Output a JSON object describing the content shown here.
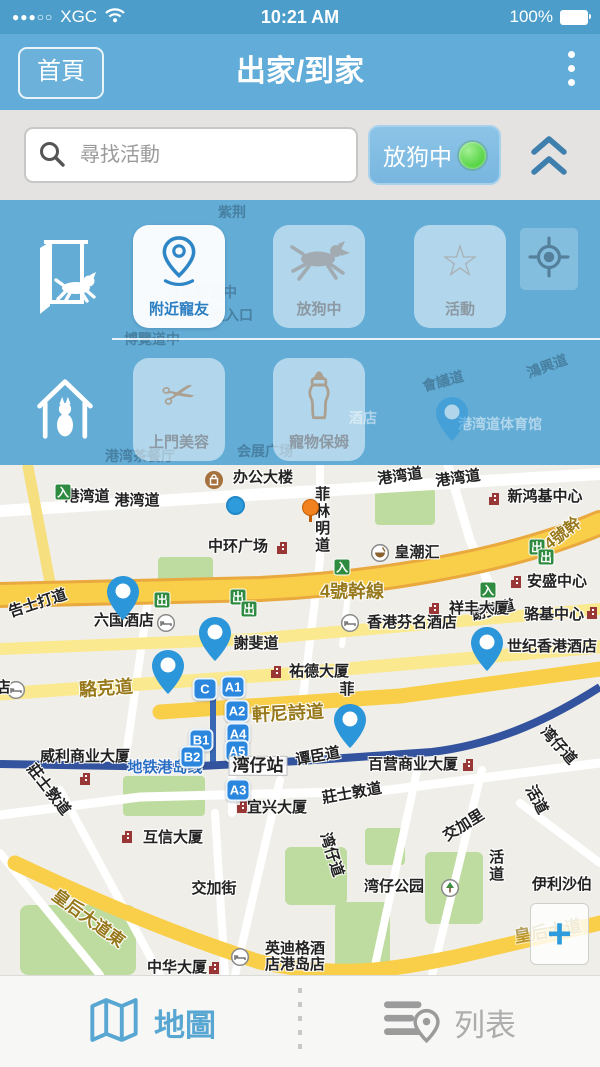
{
  "status_bar": {
    "signal_dots": "●●●○○",
    "carrier": "XGC",
    "time": "10:21 AM",
    "battery": "100%"
  },
  "header": {
    "back_label": "首頁",
    "title": "出家/到家"
  },
  "search": {
    "placeholder": "尋找活動",
    "toggle_label": "放狗中",
    "toggle_on_color": "#4ED13C"
  },
  "panel": {
    "row1": {
      "buttons": [
        {
          "label": "附近寵友",
          "icon": "location-pin-icon",
          "active": true
        },
        {
          "label": "放狗中",
          "icon": "running-dog-icon",
          "active": false
        },
        {
          "label": "活動",
          "icon": "star-icon",
          "active": false
        }
      ]
    },
    "row2": {
      "buttons": [
        {
          "label": "上門美容",
          "icon": "scissors-icon",
          "active": false
        },
        {
          "label": "寵物保姆",
          "icon": "baby-bottle-icon",
          "active": false
        }
      ]
    },
    "bg_labels": [
      {
        "t": "紫荆",
        "x": 232,
        "y": 12
      },
      {
        "t": "会议展览中",
        "x": 202,
        "y": 92
      },
      {
        "t": "道入口",
        "x": 232,
        "y": 115
      },
      {
        "t": "博覽道中",
        "x": 152,
        "y": 139
      },
      {
        "t": "會議道",
        "x": 443,
        "y": 181,
        "rot": -15
      },
      {
        "t": "鴻興道",
        "x": 547,
        "y": 166,
        "rot": -20
      },
      {
        "t": "港湾道体育馆",
        "x": 500,
        "y": 224,
        "light": 1
      },
      {
        "t": "酒店",
        "x": 363,
        "y": 218,
        "light": 1
      },
      {
        "t": "港湾茶餐厅",
        "x": 140,
        "y": 256
      },
      {
        "t": "会展广场",
        "x": 265,
        "y": 251
      }
    ]
  },
  "map": {
    "street_labels": [
      {
        "t": "港湾道",
        "x": 87,
        "y": 32
      },
      {
        "t": "港湾道",
        "x": 137,
        "y": 36
      },
      {
        "t": "港湾道",
        "x": 400,
        "y": 12,
        "rot": -8
      },
      {
        "t": "港湾道",
        "x": 458,
        "y": 14,
        "rot": -8
      },
      {
        "t": "菲林明道",
        "x": 321,
        "y": 55,
        "vert": 1
      },
      {
        "t": "告士打道",
        "x": 38,
        "y": 139,
        "rot": -18
      },
      {
        "t": "4號幹線",
        "x": 352,
        "y": 127,
        "gold": 1,
        "size": 18
      },
      {
        "t": "4號幹",
        "x": 563,
        "y": 69,
        "gold": 1,
        "rot": -38,
        "size": 16
      },
      {
        "t": "謝斐道",
        "x": 256,
        "y": 179
      },
      {
        "t": "谢斐道",
        "x": 493,
        "y": 146,
        "rot": -14
      },
      {
        "t": "駱克道",
        "x": 106,
        "y": 224,
        "gold": 1,
        "size": 18,
        "rot": -4
      },
      {
        "t": "軒尼詩道",
        "x": 288,
        "y": 249,
        "gold": 1,
        "size": 18,
        "rot": -3
      },
      {
        "t": "菲",
        "x": 347,
        "y": 225
      },
      {
        "t": "谭臣道",
        "x": 318,
        "y": 292,
        "rot": -10
      },
      {
        "t": "莊士敦道",
        "x": 48,
        "y": 325,
        "rot": 52
      },
      {
        "t": "莊士敦道",
        "x": 352,
        "y": 329,
        "rot": -10
      },
      {
        "t": "湾仔道",
        "x": 558,
        "y": 281,
        "rot": 48
      },
      {
        "t": "交加里",
        "x": 464,
        "y": 361,
        "rot": -32
      },
      {
        "t": "活道",
        "x": 536,
        "y": 335,
        "rot": 62
      },
      {
        "t": "活道",
        "x": 495,
        "y": 401,
        "vert": 1
      },
      {
        "t": "湾仔道",
        "x": 331,
        "y": 390,
        "rot": 72
      },
      {
        "t": "交加街",
        "x": 214,
        "y": 424
      },
      {
        "t": "皇后大道東",
        "x": 88,
        "y": 454,
        "rot": 36,
        "gold": 1,
        "size": 17
      },
      {
        "t": "伊利沙伯",
        "x": 562,
        "y": 420
      },
      {
        "t": "皇后大道",
        "x": 548,
        "y": 467,
        "rot": -10,
        "gold": 1,
        "faint": 1
      },
      {
        "t": "世纪香港酒店",
        "x": 552,
        "y": 182
      }
    ],
    "pois": [
      {
        "icon": "bag",
        "ix": 214,
        "iy": 15,
        "t": "办公大楼",
        "tx": 263,
        "ty": 13
      },
      {
        "icon": "bldg",
        "ix": 494,
        "iy": 34,
        "t": "新鸿基中心",
        "tx": 545,
        "ty": 32
      },
      {
        "icon": "bldg",
        "ix": 282,
        "iy": 83,
        "t": "中环广场",
        "tx": 238,
        "ty": 82
      },
      {
        "icon": "bowl",
        "ix": 380,
        "iy": 88,
        "t": "皇潮汇",
        "tx": 417,
        "ty": 88
      },
      {
        "icon": "bldg",
        "ix": 434,
        "iy": 144,
        "t": "祥丰大厦",
        "tx": 479,
        "ty": 144
      },
      {
        "icon": "bldg",
        "ix": 516,
        "iy": 117,
        "t": "安盛中心",
        "tx": 557,
        "ty": 117
      },
      {
        "icon": "bed",
        "ix": 166,
        "iy": 158,
        "t": "六国酒店",
        "tx": 124,
        "ty": 156
      },
      {
        "icon": "bed",
        "ix": 350,
        "iy": 158,
        "t": "香港芬名酒店",
        "tx": 412,
        "ty": 158
      },
      {
        "icon": "bldg",
        "ix": 592,
        "iy": 148,
        "t": "骆基中心",
        "tx": 554,
        "ty": 150
      },
      {
        "icon": "bed",
        "ix": 16,
        "iy": 225,
        "t": "店",
        "tx": 3,
        "ty": 223
      },
      {
        "icon": "bldg",
        "ix": 276,
        "iy": 207,
        "t": "祐德大厦",
        "tx": 319,
        "ty": 207
      },
      {
        "icon": "bldg",
        "ix": 85,
        "iy": 314,
        "t": "威利商业大厦",
        "tx": 85,
        "ty": 292
      },
      {
        "icon": "bldg",
        "ix": 468,
        "iy": 300,
        "t": "百营商业大厦",
        "tx": 413,
        "ty": 300
      },
      {
        "icon": "bldg",
        "ix": 242,
        "iy": 342,
        "t": "宜兴大厦",
        "tx": 277,
        "ty": 343
      },
      {
        "icon": "bldg",
        "ix": 127,
        "iy": 372,
        "t": "互信大厦",
        "tx": 173,
        "ty": 373
      },
      {
        "icon": "tree",
        "ix": 450,
        "iy": 423,
        "t": "湾仔公园",
        "tx": 394,
        "ty": 422
      },
      {
        "icon": "bed",
        "ix": 240,
        "iy": 492,
        "t": "英迪格酒",
        "t2": "店港岛店",
        "tx": 295,
        "ty": 492
      },
      {
        "icon": "bldg",
        "ix": 214,
        "iy": 503,
        "t": "中华大厦",
        "tx": 177,
        "ty": 503
      }
    ],
    "signs": [
      {
        "t": "入",
        "x": 63,
        "y": 27
      },
      {
        "t": "入",
        "x": 342,
        "y": 102
      },
      {
        "t": "入",
        "x": 488,
        "y": 125
      },
      {
        "t": "出",
        "x": 162,
        "y": 135
      },
      {
        "t": "出",
        "x": 238,
        "y": 132
      },
      {
        "t": "出",
        "x": 249,
        "y": 144
      },
      {
        "t": "出",
        "x": 537,
        "y": 82
      },
      {
        "t": "出",
        "x": 546,
        "y": 92
      }
    ],
    "exits": [
      {
        "t": "C",
        "x": 205,
        "y": 224
      },
      {
        "t": "A1",
        "x": 233,
        "y": 222
      },
      {
        "t": "A2",
        "x": 237,
        "y": 246
      },
      {
        "t": "A4",
        "x": 238,
        "y": 269
      },
      {
        "t": "A5",
        "x": 237,
        "y": 286
      },
      {
        "t": "B1",
        "x": 201,
        "y": 275
      },
      {
        "t": "B2",
        "x": 192,
        "y": 292
      },
      {
        "t": "A3",
        "x": 238,
        "y": 325
      }
    ],
    "station": {
      "line_label": "地铁港岛线",
      "lx": 165,
      "ly": 303,
      "name": "湾仔站",
      "nx": 258,
      "ny": 301
    },
    "pins": [
      {
        "x": 123,
        "y": 124
      },
      {
        "x": 215,
        "y": 165
      },
      {
        "x": 168,
        "y": 198
      },
      {
        "x": 350,
        "y": 252
      },
      {
        "x": 487,
        "y": 175
      }
    ],
    "overlay_pin": {
      "x": 452,
      "y": 210
    },
    "user_dot": {
      "x": 236,
      "y": 41
    },
    "orange_pin": {
      "x": 310,
      "y": 42
    },
    "zoom_plus": "+"
  },
  "tabbar": {
    "map_label": "地圖",
    "list_label": "列表"
  }
}
